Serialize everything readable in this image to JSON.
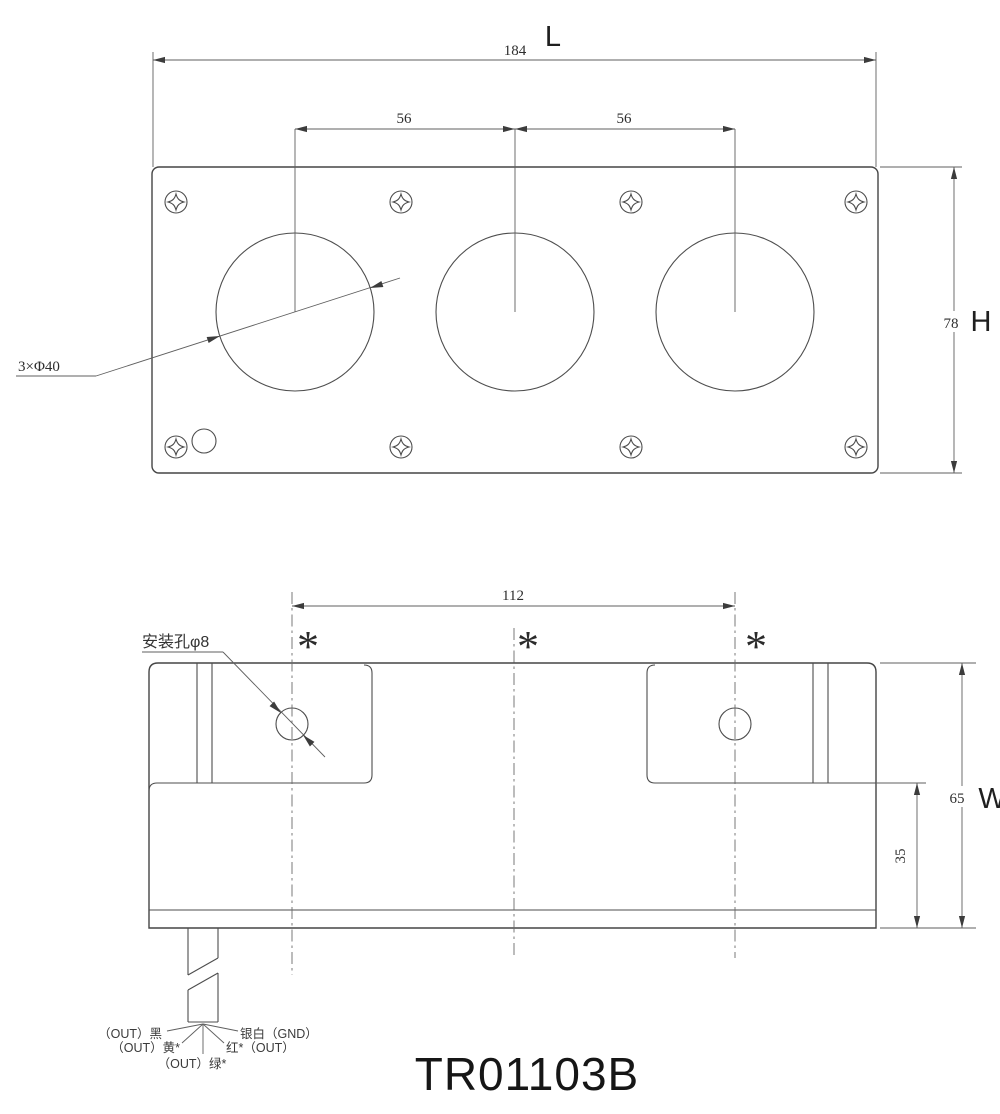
{
  "title": "TR01103B",
  "top_view": {
    "dim_length": "184",
    "label_length": "L",
    "dim_pitch_left": "56",
    "dim_pitch_right": "56",
    "dim_height": "78",
    "label_height": "H",
    "callout_holes": "3×Φ40"
  },
  "front_view": {
    "dim_hole_pitch": "112",
    "dim_width": "65",
    "label_width": "W",
    "dim_base": "35",
    "callout_mount_hole": "安装孔φ8",
    "asterisk": "*",
    "wire_labels": {
      "black": "（OUT）黑",
      "yellow": "（OUT）黄*",
      "green": "（OUT）绿*",
      "red": "红*（OUT）",
      "silver": "银白（GND）"
    }
  },
  "colors": {
    "line": "#454545",
    "text": "#2e2e2e",
    "background": "#ffffff"
  }
}
